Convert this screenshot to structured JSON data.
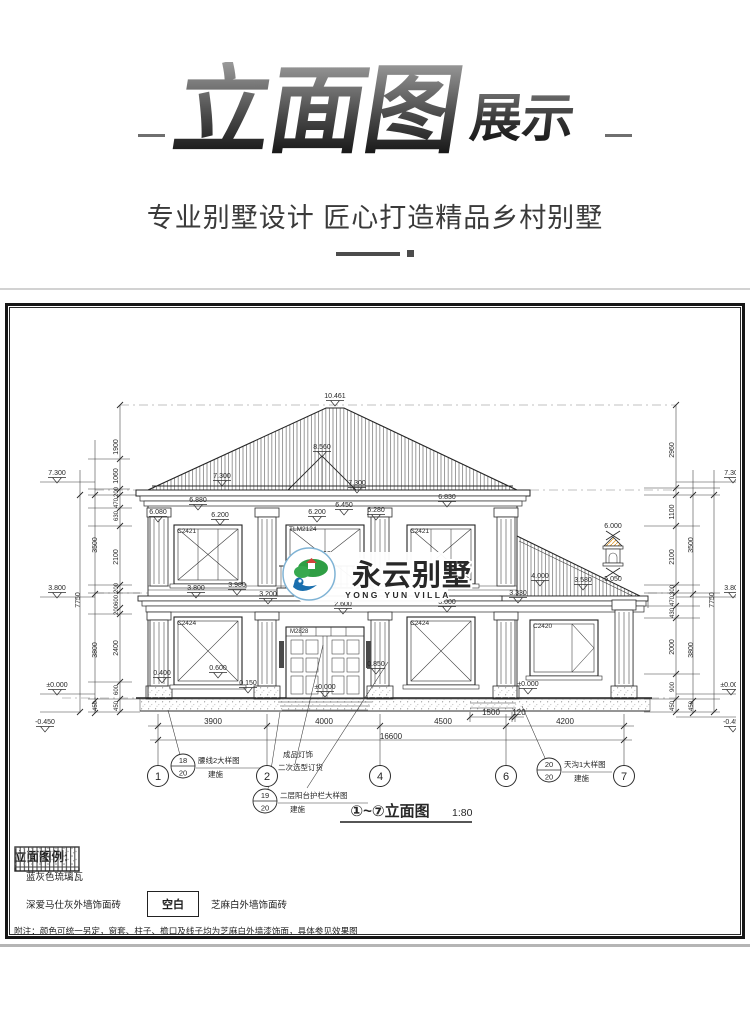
{
  "header": {
    "title_main": "立面图",
    "title_sub": "展示",
    "subtitle": "专业别墅设计 匠心打造精品乡村别墅"
  },
  "watermark": {
    "name": "永云别墅",
    "name_en": "YONG YUN VILLA"
  },
  "drawing_title": {
    "text": "①~⑦立面图",
    "scale": "1:80"
  },
  "legend": {
    "heading": "立面图例:",
    "items": [
      {
        "swatch": "vertical-hatch",
        "label": "蓝灰色琉璃瓦"
      },
      {
        "swatch": "stipple",
        "label": "深爱马仕灰外墙饰面砖"
      },
      {
        "swatch": "blank-box",
        "box_text": "空白",
        "label": "芝麻白外墙饰面砖"
      }
    ],
    "note": "附注：颜色可统一另定，窗套、柱子、檐口及线子均为芝麻白外墙漆饰面，具体参见效果图"
  },
  "colors": {
    "line": "#2b2b2b",
    "roof_hatch": "#3c3c3c",
    "dash": "#aeaeae",
    "logo_green": "#2f9e44",
    "logo_blue": "#1a6fae",
    "logo_text": "#3a4047",
    "logo_en": "#1e5f8e",
    "finial_orange": "#e2a23c"
  },
  "drawing": {
    "labels": [
      [
        "10.461",
        335,
        398,
        {
          "m": 1
        }
      ],
      [
        "8.560",
        322,
        449,
        {
          "m": 1
        }
      ],
      [
        "7.300",
        222,
        478,
        {
          "m": 1
        }
      ],
      [
        "7.300",
        357,
        485,
        {
          "m": 1
        }
      ],
      [
        "7.300",
        57,
        475,
        {
          "m": 1
        }
      ],
      [
        "3.800",
        57,
        590,
        {
          "m": 1
        }
      ],
      [
        "±0.000",
        57,
        687,
        {
          "m": 1
        }
      ],
      [
        "-0.450",
        45,
        724,
        {
          "m": 1
        }
      ],
      [
        "6.080",
        158,
        514,
        {
          "m": 1
        }
      ],
      [
        "6.880",
        198,
        502,
        {
          "m": 1
        }
      ],
      [
        "6.200",
        220,
        517,
        {
          "m": 1
        }
      ],
      [
        "6.200",
        317,
        514,
        {
          "m": 1
        }
      ],
      [
        "6.450",
        344,
        507,
        {
          "m": 1
        }
      ],
      [
        "6.280",
        376,
        512,
        {
          "m": 1
        }
      ],
      [
        "6.830",
        447,
        499,
        {
          "m": 1
        }
      ],
      [
        "6.000",
        613,
        528
      ],
      [
        "5.050",
        613,
        581
      ],
      [
        "4.800",
        322,
        556,
        {
          "m": 1
        }
      ],
      [
        "3.980",
        237,
        587,
        {
          "m": 1
        }
      ],
      [
        "3.800",
        196,
        590,
        {
          "m": 1
        }
      ],
      [
        "3.100",
        452,
        572,
        {
          "m": 1
        }
      ],
      [
        "4.000",
        540,
        578,
        {
          "m": 1
        }
      ],
      [
        "3.580",
        583,
        582,
        {
          "m": 1
        }
      ],
      [
        "3.330",
        518,
        595,
        {
          "m": 1
        }
      ],
      [
        "3.200",
        268,
        596,
        {
          "m": 1
        }
      ],
      [
        "2.600",
        343,
        606,
        {
          "m": 1
        }
      ],
      [
        "3.000",
        447,
        604,
        {
          "m": 1
        }
      ],
      [
        "0.400",
        162,
        675,
        {
          "m": 1
        }
      ],
      [
        "0.600",
        218,
        670,
        {
          "m": 1
        }
      ],
      [
        "0.150",
        248,
        685,
        {
          "m": 1
        }
      ],
      [
        "±0.000",
        325,
        689,
        {
          "m": 1
        }
      ],
      [
        "0.850",
        376,
        666,
        {
          "m": 1
        }
      ],
      [
        "±0.000",
        528,
        686,
        {
          "m": 1
        }
      ],
      [
        "C2421",
        177,
        533,
        {
          "a": "s",
          "s": 6.5
        }
      ],
      [
        "TLM2124",
        289,
        531,
        {
          "a": "s",
          "s": 6.5
        }
      ],
      [
        "C2421",
        410,
        533,
        {
          "a": "s",
          "s": 6.5
        }
      ],
      [
        "C2424",
        177,
        625,
        {
          "a": "s",
          "s": 6.5
        }
      ],
      [
        "M2828",
        290,
        633,
        {
          "a": "s",
          "s": 6
        }
      ],
      [
        "C2424",
        410,
        625,
        {
          "a": "s",
          "s": 6.5
        }
      ],
      [
        "C2420",
        533,
        628,
        {
          "a": "s",
          "s": 6.5
        }
      ],
      [
        "3900",
        213,
        724,
        {
          "s": 8
        }
      ],
      [
        "4000",
        324,
        724,
        {
          "s": 8
        }
      ],
      [
        "4500",
        443,
        724,
        {
          "s": 8
        }
      ],
      [
        "4200",
        565,
        724,
        {
          "s": 8
        }
      ],
      [
        "16600",
        391,
        739,
        {
          "s": 8
        }
      ],
      [
        "1500",
        491,
        715,
        {
          "s": 8
        }
      ],
      [
        "120",
        519,
        715,
        {
          "s": 8
        }
      ],
      [
        "1900",
        118,
        447,
        {
          "r": -90
        }
      ],
      [
        "1060",
        118,
        476,
        {
          "r": -90
        }
      ],
      [
        "200",
        118,
        492,
        {
          "r": -90,
          "s": 6
        }
      ],
      [
        "470",
        118,
        503,
        {
          "r": -90,
          "s": 6
        }
      ],
      [
        "630",
        118,
        516,
        {
          "r": -90,
          "s": 6
        }
      ],
      [
        "2100",
        118,
        557,
        {
          "r": -90
        }
      ],
      [
        "200",
        118,
        588,
        {
          "r": -90,
          "s": 6
        }
      ],
      [
        "600",
        118,
        600,
        {
          "r": -90,
          "s": 6
        }
      ],
      [
        "200",
        118,
        610,
        {
          "r": -90,
          "s": 6
        }
      ],
      [
        "2400",
        118,
        648,
        {
          "r": -90
        }
      ],
      [
        "600",
        118,
        690,
        {
          "r": -90,
          "s": 6
        }
      ],
      [
        "450",
        118,
        706,
        {
          "r": -90,
          "s": 6
        }
      ],
      [
        "3500",
        97,
        545,
        {
          "r": -90
        }
      ],
      [
        "3800",
        97,
        650,
        {
          "r": -90
        }
      ],
      [
        "450",
        97,
        706,
        {
          "r": -90,
          "s": 6
        }
      ],
      [
        "7750",
        80,
        600,
        {
          "r": -90
        }
      ],
      [
        "2960",
        674,
        450,
        {
          "r": -90
        }
      ],
      [
        "1100",
        674,
        512,
        {
          "r": -90
        }
      ],
      [
        "2100",
        674,
        557,
        {
          "r": -90
        }
      ],
      [
        "300",
        674,
        590,
        {
          "r": -90,
          "s": 6
        }
      ],
      [
        "470",
        674,
        601,
        {
          "r": -90,
          "s": 6
        }
      ],
      [
        "430",
        674,
        613,
        {
          "r": -90,
          "s": 6
        }
      ],
      [
        "2000",
        674,
        647,
        {
          "r": -90
        }
      ],
      [
        "900",
        674,
        687,
        {
          "r": -90,
          "s": 6
        }
      ],
      [
        "450",
        674,
        706,
        {
          "r": -90,
          "s": 6
        }
      ],
      [
        "3500",
        693,
        545,
        {
          "r": -90
        }
      ],
      [
        "3800",
        693,
        650,
        {
          "r": -90
        }
      ],
      [
        "450",
        693,
        706,
        {
          "r": -90,
          "s": 6
        }
      ],
      [
        "7750",
        714,
        600,
        {
          "r": -90
        }
      ],
      [
        "7.300",
        733,
        475,
        {
          "m": 1
        }
      ],
      [
        "3.800",
        733,
        590,
        {
          "m": 1
        }
      ],
      [
        "±0.000",
        731,
        687,
        {
          "m": 1
        }
      ],
      [
        "-0.450",
        733,
        724,
        {
          "m": 1
        }
      ],
      [
        "成品灯饰",
        283,
        757,
        {
          "a": "s",
          "s": 7.5
        }
      ],
      [
        "二次选型订货",
        278,
        770,
        {
          "a": "s",
          "s": 7.5
        }
      ]
    ],
    "grid_bubbles": [
      {
        "x": 158,
        "label": "1"
      },
      {
        "x": 267,
        "label": "2"
      },
      {
        "x": 380,
        "label": "4"
      },
      {
        "x": 506,
        "label": "6"
      },
      {
        "x": 624,
        "label": "7"
      }
    ],
    "detail_callouts": [
      {
        "x": 183,
        "y": 766,
        "num": "18",
        "sheet": "20",
        "line1": "腰线2大样图",
        "line2": "建施"
      },
      {
        "x": 265,
        "y": 801,
        "num": "19",
        "sheet": "20",
        "line1": "二层阳台护栏大样图",
        "line2": "建施"
      },
      {
        "x": 549,
        "y": 770,
        "num": "20",
        "sheet": "20",
        "line1": "天沟1大样图",
        "line2": "建施"
      }
    ]
  }
}
